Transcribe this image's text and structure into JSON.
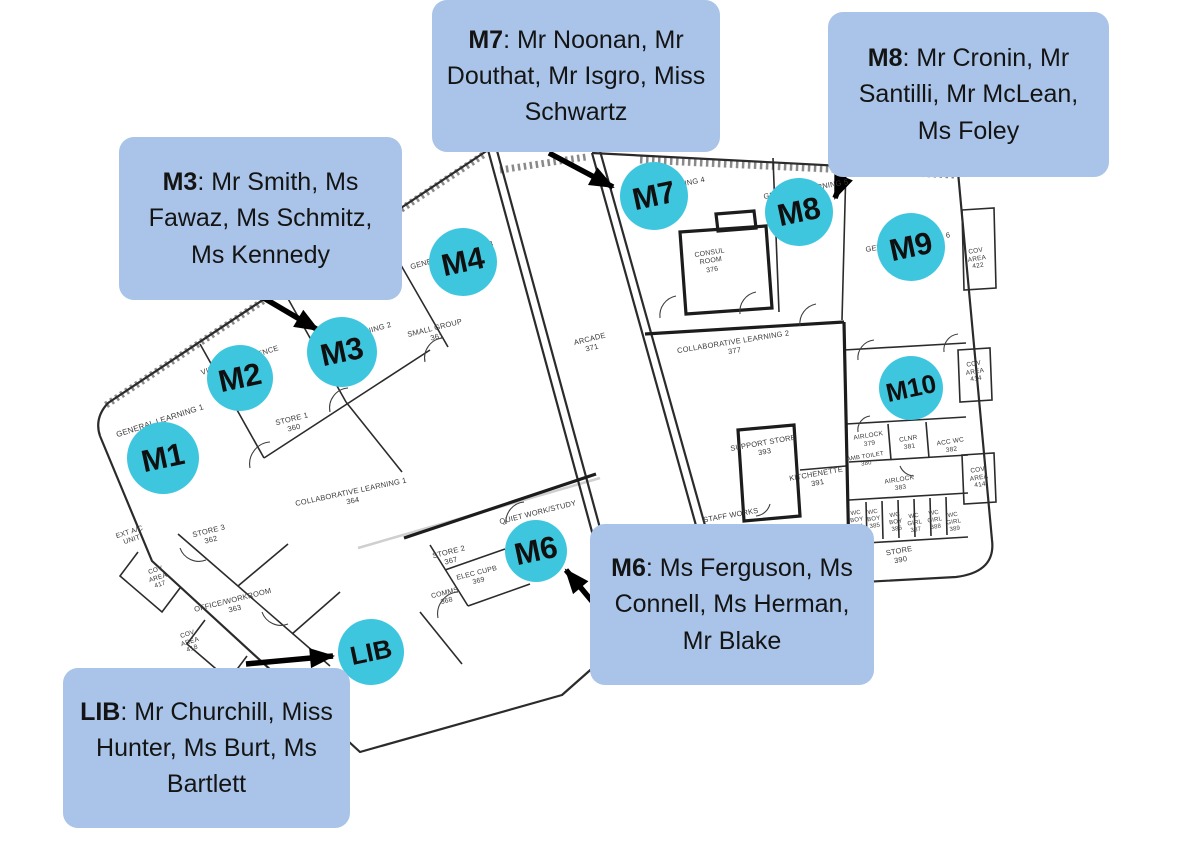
{
  "colors": {
    "callout_bg": "#a9c4e8",
    "marker_fill": "#3fc6df",
    "arrow": "#000000",
    "wall": "#2b2b2b",
    "plan_text": "#3a3a3a"
  },
  "callouts": [
    {
      "id": "m7",
      "prefix": "M7",
      "names": ": Mr Noonan, Mr Douthat, Mr Isgro, Miss Schwartz"
    },
    {
      "id": "m8",
      "prefix": "M8",
      "names": ": Mr Cronin, Mr Santilli, Mr McLean, Ms Foley"
    },
    {
      "id": "m3",
      "prefix": "M3",
      "names": ": Mr Smith, Ms Fawaz, Ms Schmitz, Ms Kennedy"
    },
    {
      "id": "m6",
      "prefix": "M6",
      "names": ": Ms Ferguson, Ms Connell, Ms Herman, Mr Blake"
    },
    {
      "id": "lib",
      "prefix": "LIB",
      "names": ": Mr Churchill, Miss Hunter, Ms Burt, Ms Bartlett"
    }
  ],
  "markers": [
    {
      "label": "M1",
      "x": 163,
      "y": 458,
      "r": 36
    },
    {
      "label": "M2",
      "x": 240,
      "y": 378,
      "r": 33
    },
    {
      "label": "M3",
      "x": 342,
      "y": 352,
      "r": 35
    },
    {
      "label": "M4",
      "x": 463,
      "y": 262,
      "r": 34
    },
    {
      "label": "M6",
      "x": 536,
      "y": 551,
      "r": 31
    },
    {
      "label": "M7",
      "x": 654,
      "y": 196,
      "r": 34
    },
    {
      "label": "M8",
      "x": 799,
      "y": 212,
      "r": 34
    },
    {
      "label": "M9",
      "x": 911,
      "y": 247,
      "r": 34
    },
    {
      "label": "M10",
      "x": 911,
      "y": 388,
      "r": 32
    },
    {
      "label": "LIB",
      "x": 371,
      "y": 652,
      "r": 33
    }
  ],
  "arrows": [
    {
      "target": "M7",
      "x1": 549,
      "y1": 153,
      "x2": 613,
      "y2": 187
    },
    {
      "target": "M8",
      "x1": 856,
      "y1": 146,
      "x2": 835,
      "y2": 198
    },
    {
      "target": "M3",
      "x1": 257,
      "y1": 294,
      "x2": 318,
      "y2": 330
    },
    {
      "target": "M6",
      "x1": 611,
      "y1": 624,
      "x2": 566,
      "y2": 570
    },
    {
      "target": "LIB",
      "x1": 246,
      "y1": 664,
      "x2": 333,
      "y2": 656
    }
  ],
  "room_labels": [
    {
      "t": "GENERAL LEARNING 1",
      "x": 160,
      "y": 421,
      "r": -18,
      "s": 8
    },
    {
      "t": "VIDEO CONFERENCE",
      "x": 240,
      "y": 361,
      "r": -18,
      "s": 7.5
    },
    {
      "t": "GENERAL LEARNING 2",
      "x": 350,
      "y": 337,
      "r": -16,
      "s": 7.5
    },
    {
      "t": "STORE 1\n360",
      "x": 293,
      "y": 424,
      "r": -14,
      "s": 7.5
    },
    {
      "t": "SMALL GROUP\n361",
      "x": 436,
      "y": 333,
      "r": -14,
      "s": 7.5
    },
    {
      "t": "GENERAL LEARNING 3",
      "x": 452,
      "y": 256,
      "r": -16,
      "s": 7.5
    },
    {
      "t": "COLLABORATIVE LEARNING 1\n364",
      "x": 352,
      "y": 497,
      "r": -12,
      "s": 7.5
    },
    {
      "t": "EXT A/C\nUNIT",
      "x": 131,
      "y": 537,
      "r": -18,
      "s": 7
    },
    {
      "t": "STORE 3\n362",
      "x": 210,
      "y": 536,
      "r": -14,
      "s": 7.5
    },
    {
      "t": "COV\nAREA\n417",
      "x": 158,
      "y": 578,
      "r": -18,
      "s": 6.5
    },
    {
      "t": "OFFICE/WORKROOM\n363",
      "x": 234,
      "y": 605,
      "r": -14,
      "s": 7.5
    },
    {
      "t": "COV\nAREA\n418",
      "x": 190,
      "y": 642,
      "r": -18,
      "s": 6.5
    },
    {
      "t": "QUIET WORK/STUDY",
      "x": 538,
      "y": 513,
      "r": -14,
      "s": 7.5
    },
    {
      "t": "STORE 2\n367",
      "x": 450,
      "y": 557,
      "r": -14,
      "s": 7.5
    },
    {
      "t": "ELEC CUPB\n369",
      "x": 478,
      "y": 578,
      "r": -14,
      "s": 7
    },
    {
      "t": "COMMS\n368",
      "x": 446,
      "y": 598,
      "r": -14,
      "s": 7
    },
    {
      "t": "ARCADE\n371",
      "x": 591,
      "y": 344,
      "r": -14,
      "s": 7.5
    },
    {
      "t": "GENERAL LEARNING 4",
      "x": 663,
      "y": 189,
      "r": -12,
      "s": 7.5
    },
    {
      "t": "GENERAL LEARNING 5",
      "x": 806,
      "y": 190,
      "r": -10,
      "s": 7.5
    },
    {
      "t": "GENERAL LEARNING 6",
      "x": 908,
      "y": 243,
      "r": -10,
      "s": 7.5
    },
    {
      "t": "CONSUL\nROOM\n376",
      "x": 711,
      "y": 262,
      "r": -9,
      "s": 7
    },
    {
      "t": "COLLABORATIVE LEARNING 2\n377",
      "x": 734,
      "y": 347,
      "r": -9,
      "s": 7.5
    },
    {
      "t": "COV\nAREA\n422",
      "x": 977,
      "y": 259,
      "r": -9,
      "s": 6.5
    },
    {
      "t": "FACILITIES",
      "x": 915,
      "y": 378,
      "r": -10,
      "s": 7.5
    },
    {
      "t": "COV\nAREA\n414",
      "x": 975,
      "y": 372,
      "r": -9,
      "s": 6.5
    },
    {
      "t": "SUPPORT STORE\n393",
      "x": 764,
      "y": 448,
      "r": -10,
      "s": 7.5
    },
    {
      "t": "KITCHENETTE\n391",
      "x": 817,
      "y": 479,
      "r": -10,
      "s": 7.5
    },
    {
      "t": "STAFF WORKS",
      "x": 731,
      "y": 516,
      "r": -10,
      "s": 7.5
    },
    {
      "t": "AIRLOCK\n379",
      "x": 869,
      "y": 440,
      "r": -9,
      "s": 6.5
    },
    {
      "t": "AMB TOILET\n380",
      "x": 866,
      "y": 461,
      "r": -9,
      "s": 6
    },
    {
      "t": "CLNR\n381",
      "x": 909,
      "y": 443,
      "r": -9,
      "s": 6.5
    },
    {
      "t": "ACC WC\n382",
      "x": 951,
      "y": 446,
      "r": -9,
      "s": 6.5
    },
    {
      "t": "AIRLOCK\n383",
      "x": 900,
      "y": 484,
      "r": -9,
      "s": 6.5
    },
    {
      "t": "COV\nAREA\n414",
      "x": 979,
      "y": 478,
      "r": -9,
      "s": 6.5
    },
    {
      "t": "WC\nBOY\n384",
      "x": 857,
      "y": 521,
      "r": -9,
      "s": 6
    },
    {
      "t": "WC\nBOY\n385",
      "x": 874,
      "y": 520,
      "r": -9,
      "s": 6
    },
    {
      "t": "WC\nBOY\n386",
      "x": 896,
      "y": 523,
      "r": -9,
      "s": 6
    },
    {
      "t": "WC\nGIRL\n387",
      "x": 915,
      "y": 524,
      "r": -9,
      "s": 6
    },
    {
      "t": "WC\nGIRL\n388",
      "x": 935,
      "y": 521,
      "r": -9,
      "s": 6
    },
    {
      "t": "WC\nGIRL\n389",
      "x": 954,
      "y": 523,
      "r": -9,
      "s": 6
    },
    {
      "t": "STORE\n390",
      "x": 900,
      "y": 556,
      "r": -10,
      "s": 7.5
    }
  ]
}
